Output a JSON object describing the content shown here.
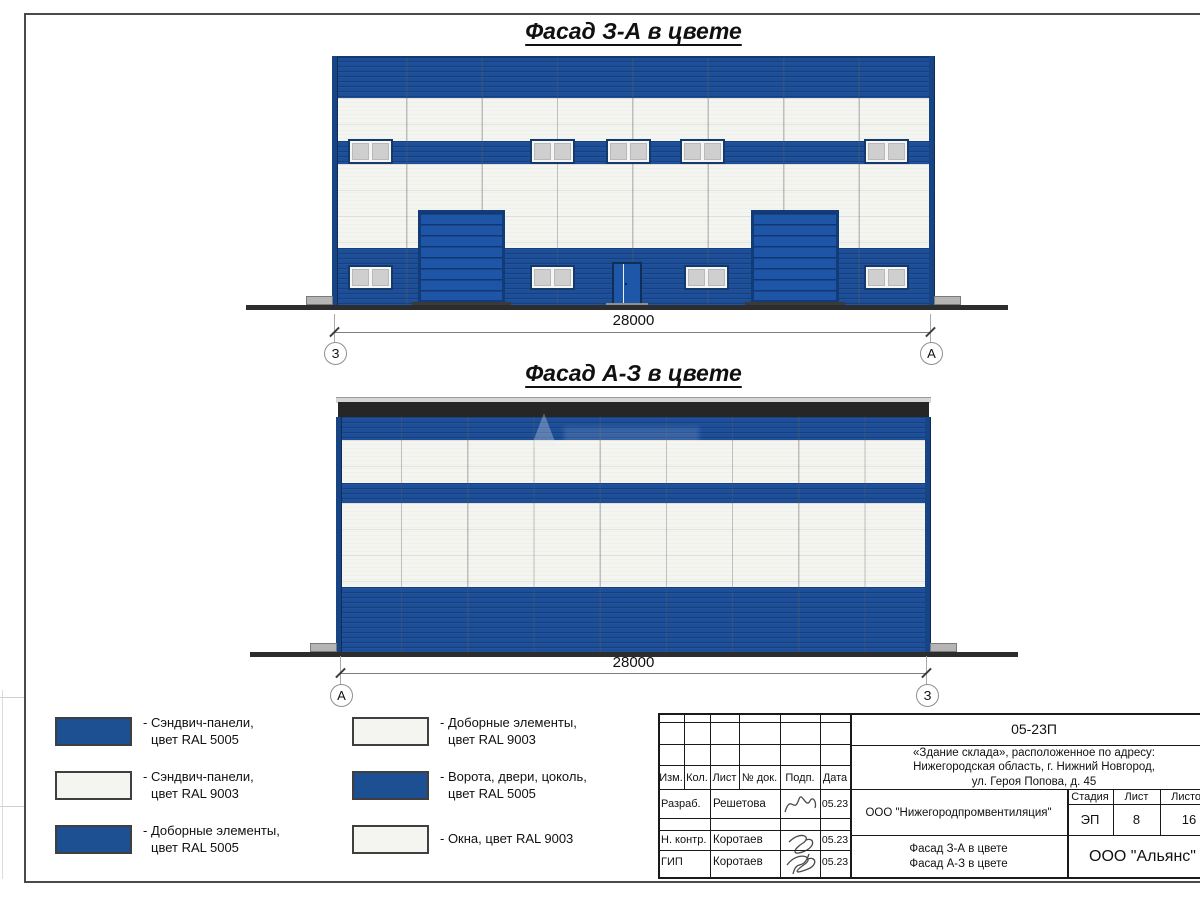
{
  "drawing": {
    "facades": [
      {
        "title": "Фасад З-А в цвете",
        "dimension": "28000",
        "axis_left": "З",
        "axis_right": "А"
      },
      {
        "title": "Фасад А-З в цвете",
        "dimension": "28000",
        "axis_left": "А",
        "axis_right": "З"
      }
    ],
    "legend": [
      {
        "swatch": "blue",
        "label_line1": "- Сэндвич-панели,",
        "label_line2": "цвет RAL 5005"
      },
      {
        "swatch": "white",
        "label_line1": "- Сэндвич-панели,",
        "label_line2": "цвет RAL 9003"
      },
      {
        "swatch": "blue",
        "label_line1": "- Доборные элементы,",
        "label_line2": "цвет RAL 5005"
      },
      {
        "swatch": "white",
        "label_line1": "- Доборные элементы,",
        "label_line2": "цвет RAL 9003"
      },
      {
        "swatch": "blue",
        "label_line1": "- Ворота, двери, цоколь,",
        "label_line2": "цвет RAL 5005"
      },
      {
        "swatch": "white",
        "label_line1": "- Окна, цвет RAL 9003",
        "label_line2": ""
      }
    ],
    "stamp": {
      "doc_number": "05-23П",
      "project_line1": "«Здание склада», расположенное по адресу:",
      "project_line2": "Нижегородская область, г. Нижний Новгород,",
      "project_line3": "ул. Героя Попова, д. 45",
      "col_headers": {
        "izm": "Изм.",
        "kol": "Кол.",
        "list": "Лист",
        "doc_no": "№ док.",
        "podp": "Подп.",
        "data": "Дата"
      },
      "signature_rows": [
        {
          "role": "Разраб.",
          "name": "Решетова",
          "date": "05.23"
        },
        {
          "role": "Н. контр.",
          "name": "Коротаев",
          "date": "05.23"
        },
        {
          "role": "ГИП",
          "name": "Коротаев",
          "date": "05.23"
        }
      ],
      "organization": "ООО \"Нижегородпромвентиляция\"",
      "stage_header": "Стадия",
      "sheet_header": "Лист",
      "sheets_header": "Листов",
      "stage": "ЭП",
      "sheet_number": "8",
      "sheets_total": "16",
      "content_line1": "Фасад З-А в цвете",
      "content_line2": "Фасад А-З в цвете",
      "company": "ООО \"Альянс\""
    },
    "colors": {
      "ral5005_blue": "#1d4f99",
      "ral9003_white": "#f4f5f0",
      "coping_dark": "#262626"
    }
  }
}
